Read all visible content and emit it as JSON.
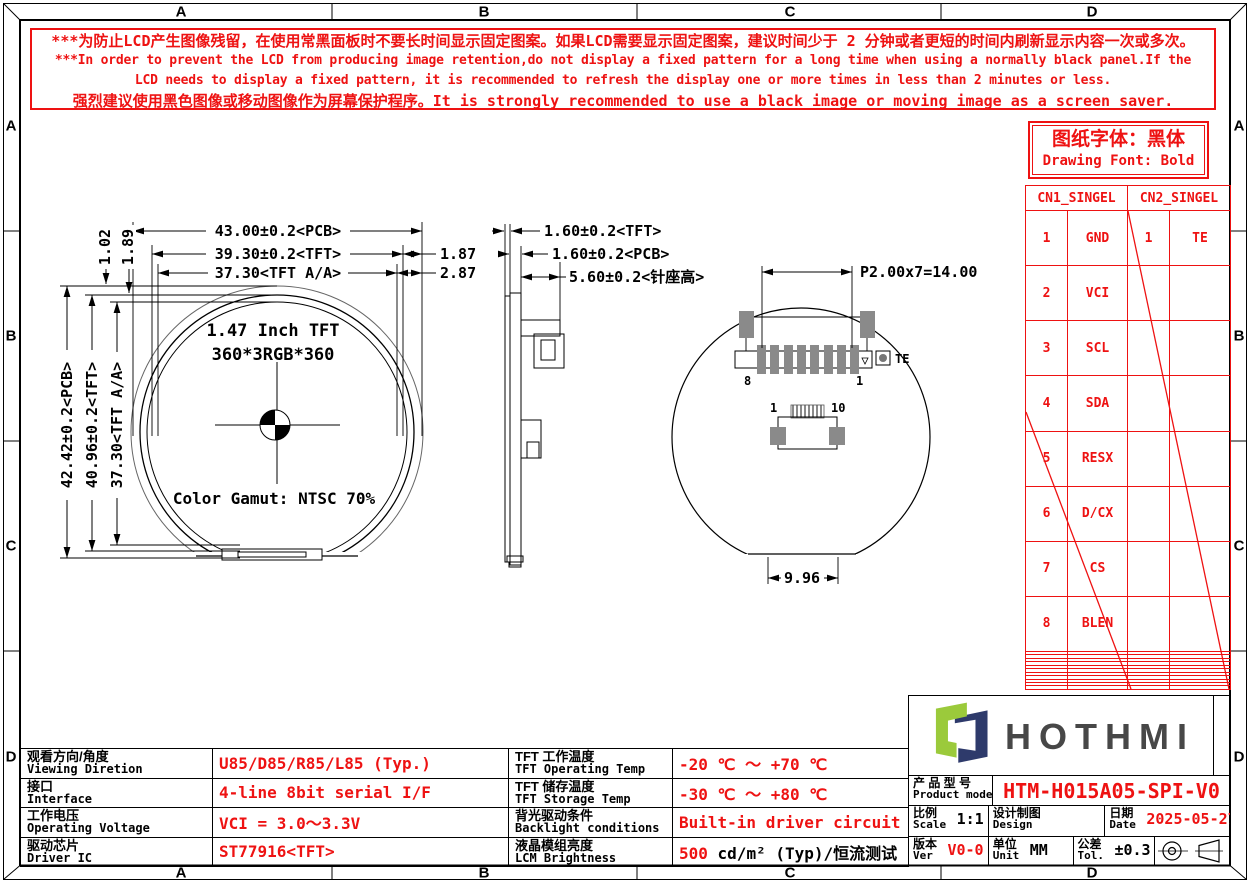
{
  "colors": {
    "red": "#ee1212",
    "pad_gray": "#8a8a8a",
    "logo_green": "#9bca3b",
    "logo_navy": "#2e3a6b",
    "brand_gray": "#474747"
  },
  "border": {
    "cols": [
      "A",
      "B",
      "C",
      "D"
    ],
    "rows": [
      "A",
      "B",
      "C",
      "D"
    ]
  },
  "warning": {
    "lines": [
      "***为防止LCD产生图像残留，在使用常黑面板时不要长时间显示固定图案。如果LCD需要显示固定图案，建议时间少于 2 分钟或者更短的时间内刷新显示内容一次或多次。",
      "***In order to prevent the LCD from producing image retention,do not display a fixed pattern for a long time when using a normally black panel.If the",
      "LCD needs to display a fixed pattern, it is recommended to refresh the display one or more times in less than 2 minutes or less.",
      "强烈建议使用黑色图像或移动图像作为屏幕保护程序。It is strongly recommended to use a black image or moving image as a screen saver."
    ]
  },
  "font_note": {
    "cn": "图纸字体：黑体",
    "en": "Drawing Font: Bold"
  },
  "pin_tables": {
    "cn1_title": "CN1_SINGEL",
    "cn2_title": "CN2_SINGEL",
    "cn1_pins": [
      {
        "no": "1",
        "name": "GND"
      },
      {
        "no": "2",
        "name": "VCI"
      },
      {
        "no": "3",
        "name": "SCL"
      },
      {
        "no": "4",
        "name": "SDA"
      },
      {
        "no": "5",
        "name": "RESX"
      },
      {
        "no": "6",
        "name": "D/CX"
      },
      {
        "no": "7",
        "name": "CS"
      },
      {
        "no": "8",
        "name": "BLEN"
      }
    ],
    "cn2_pins": [
      {
        "no": "1",
        "name": "TE"
      }
    ],
    "empty_rows": 11
  },
  "front_view": {
    "title": "1.47 Inch TFT",
    "resolution": "360*3RGB*360",
    "gamut": "Color Gamut: NTSC 70%",
    "dim_width_pcb": "43.00±0.2<PCB>",
    "dim_width_tft": "39.30±0.2<TFT>",
    "dim_width_aa": "37.30<TFT A/A>",
    "dim_gap_tft": "1.87",
    "dim_gap_aa": "2.87",
    "dim_top_1": "1.02",
    "dim_top_2": "1.89",
    "dim_height_pcb": "42.42±0.2<PCB>",
    "dim_height_tft": "40.96±0.2<TFT>",
    "dim_height_aa": "37.30<TFT A/A>"
  },
  "side_view": {
    "dim_tft_thk": "1.60±0.2<TFT>",
    "dim_pcb_thk": "1.60±0.2<PCB>",
    "dim_header_h": "5.60±0.2<针座高>"
  },
  "back_view": {
    "dim_pitch": "P2.00x7=14.00",
    "label_pin8": "8",
    "label_pin1": "1",
    "label_te": "TE",
    "label_p1": "1",
    "label_p10": "10",
    "dim_flat": "9.96"
  },
  "spec_table": {
    "rows": [
      {
        "label_cn": "观看方向/角度",
        "label_en": "Viewing Diretion",
        "value": "U85/D85/R85/L85 (Typ.)",
        "label2_cn": "TFT 工作温度",
        "label2_en": "TFT Operating Temp",
        "value2": "-20 ℃ ～ +70 ℃"
      },
      {
        "label_cn": "接口",
        "label_en": "Interface",
        "value": "4-line 8bit serial I/F",
        "label2_cn": "TFT 储存温度",
        "label2_en": "TFT Storage Temp",
        "value2": "-30 ℃ ～ +80 ℃"
      },
      {
        "label_cn": "工作电压",
        "label_en": "Operating Voltage",
        "value": "VCI = 3.0～3.3V",
        "label2_cn": "背光驱动条件",
        "label2_en": "Backlight conditions",
        "value2": "Built-in driver circuit"
      },
      {
        "label_cn": "驱动芯片",
        "label_en": "Driver IC",
        "value": "ST77916<TFT>",
        "label2_cn": "液晶模组亮度",
        "label2_en": "LCM Brightness",
        "value2_red": "500",
        "value2_rest": " cd/m² (Typ)/恒流测试"
      }
    ]
  },
  "title_block": {
    "brand": "HOTHMI",
    "product_label_cn": "产 品 型 号",
    "product_label_en": "Product model",
    "product_value": "HTM-H015A05-SPI-V0",
    "scale_cn": "比例",
    "scale_en": "Scale",
    "scale_value": "1:1",
    "design_cn": "设计制图",
    "design_en": "Design",
    "date_cn": "日期",
    "date_en": "Date",
    "date_value": "2025-05-27",
    "ver_cn": "版本",
    "ver_en": "Ver",
    "ver_value": "V0-0",
    "unit_cn": "单位",
    "unit_en": "Unit",
    "unit_value": "MM",
    "tol_cn": "公差",
    "tol_en": "Tol.",
    "tol_value": "±0.3"
  }
}
